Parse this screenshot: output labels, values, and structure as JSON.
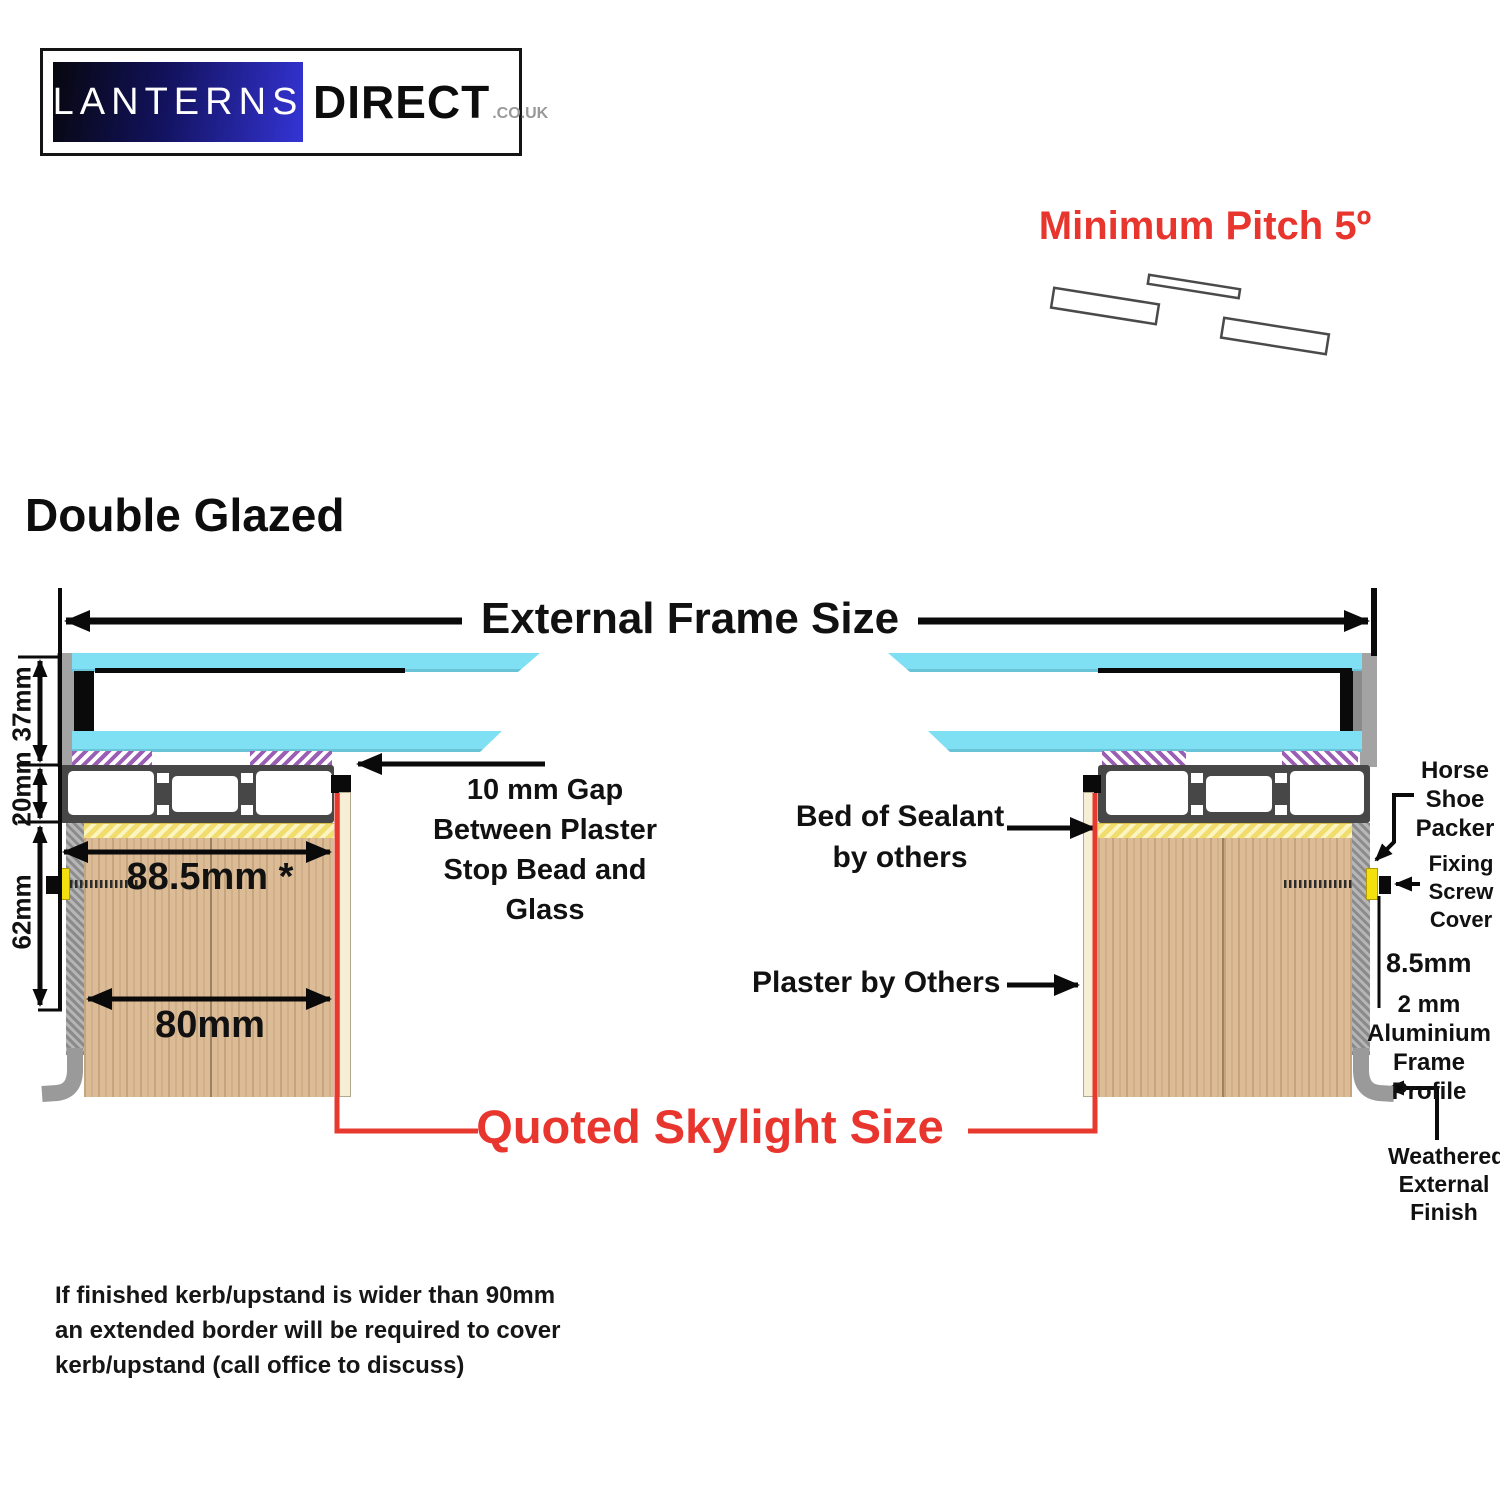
{
  "logo": {
    "primary": "LANTERNS",
    "secondary": "DIRECT",
    "tld": ".CO.UK"
  },
  "pitch_label": "Minimum Pitch 5º",
  "section_title": "Double Glazed",
  "labels": {
    "external_frame": "External Frame Size",
    "quoted_skylight": "Quoted Skylight Size",
    "dim_37": "37mm",
    "dim_20": "20mm",
    "dim_62": "62mm",
    "dim_885": "88.5mm *",
    "dim_80": "80mm",
    "dim_85": "8.5mm",
    "gap_lines": [
      "10 mm Gap",
      "Between Plaster",
      "Stop Bead and",
      "Glass"
    ],
    "sealant_lines": [
      "Bed of Sealant",
      "by others"
    ],
    "plaster": "Plaster by Others",
    "horseshoe_lines": [
      "Horse",
      "Shoe",
      "Packer"
    ],
    "fixing_lines": [
      "Fixing",
      "Screw",
      "Cover"
    ],
    "alu_lines": [
      "2 mm",
      "Aluminium",
      "Frame Profile"
    ],
    "weathered_lines": [
      "Weathered",
      "External",
      "Finish"
    ]
  },
  "footnote_lines": [
    "If finished kerb/upstand is wider than 90mm",
    "an extended border will be required to cover",
    "kerb/upstand (call office to discuss)"
  ],
  "colors": {
    "accent_red": "#e8352e",
    "glass_cyan": "#7ee0f2",
    "gasket_purple": "#9a5fb5",
    "sealant_yellow": "#f2e175",
    "wood_tan": "#dcbc96",
    "frame_grey": "#9c9c9c",
    "profile_dark": "#474747",
    "packer_yellow": "#f2e10e",
    "plaster_cream": "#f7eed6",
    "logo_blue": "#3434d6",
    "logo_grey": "#999999"
  }
}
